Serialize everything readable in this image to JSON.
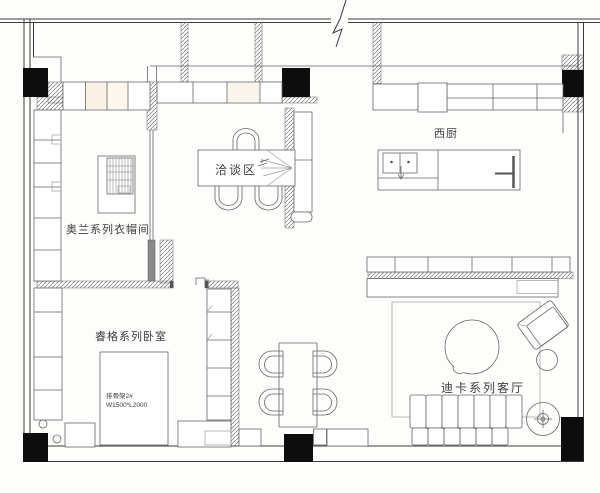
{
  "drawing": {
    "kind": "apartment-floor-plan",
    "canvas": {
      "width": 600,
      "height": 493
    },
    "colors": {
      "background": "#fdfdfc",
      "line": "#3a3a3a",
      "furniture": "#666666",
      "light": "#9c9c9c",
      "column": "#0d0d0d",
      "cabinet_tint": "#f8f1e4",
      "text": "#3d3d3d"
    },
    "rooms": [
      {
        "id": "cloakroom",
        "label": "奥兰系列衣帽间"
      },
      {
        "id": "meeting-area",
        "label": "洽谈区"
      },
      {
        "id": "west-kitchen",
        "label": "西厨"
      },
      {
        "id": "bedroom",
        "label": "睿格系列卧室"
      },
      {
        "id": "living-room",
        "label": "迪卡系列客厅"
      }
    ],
    "bed_annotation": {
      "line1": "排骨架2#",
      "line2": "W1500*L2000"
    }
  }
}
